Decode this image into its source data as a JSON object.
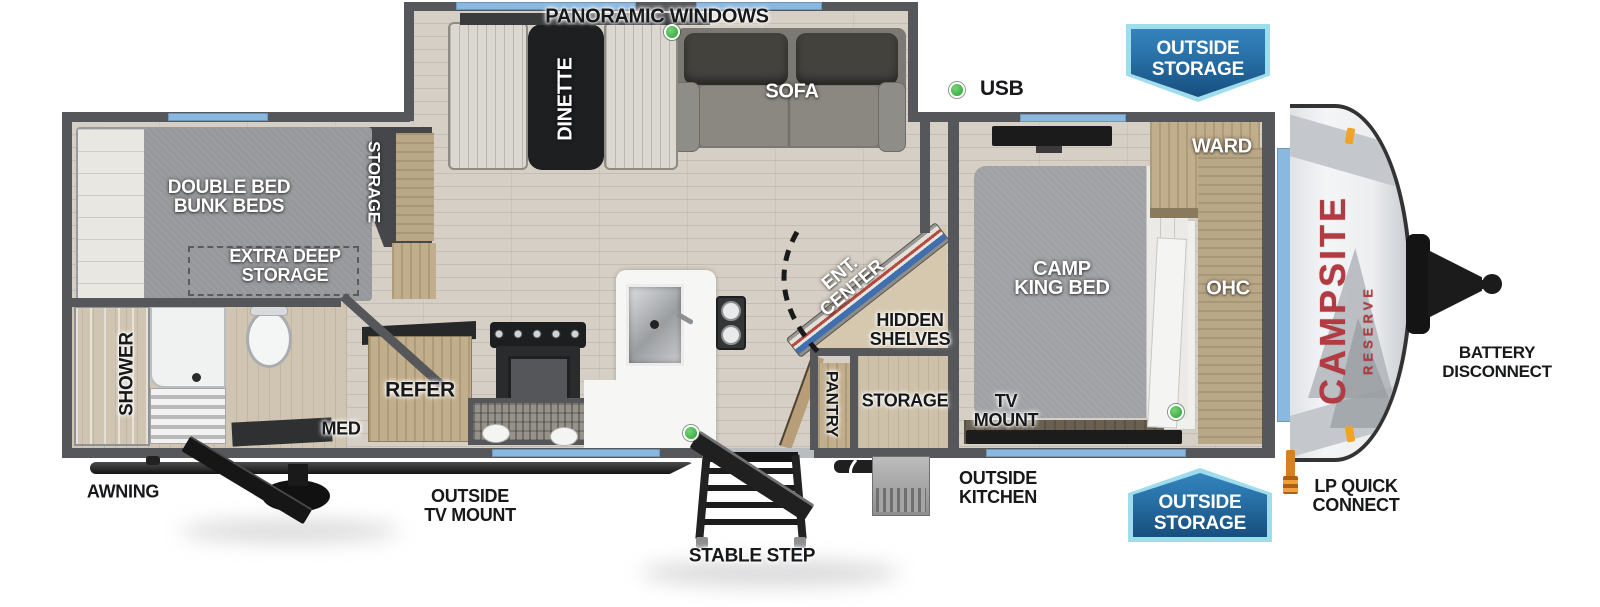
{
  "floorplan": {
    "brand": {
      "name": "CAMPSITE",
      "sub": "RESERVE",
      "color": "#b23a40"
    },
    "colors": {
      "badge_blue": "#1d6096",
      "badge_border": "#9fdcec",
      "window_blue": "#8ab8de",
      "wall_gray": "#55575a",
      "green_marker": "#3cb043",
      "lp_orange": "#d87f1f"
    },
    "exterior": {
      "panoramic_windows": "PANORAMIC WINDOWS",
      "usb": "USB",
      "outside_storage_top": {
        "line1": "OUTSIDE",
        "line2": "STORAGE"
      },
      "outside_storage_bottom": {
        "line1": "OUTSIDE",
        "line2": "STORAGE"
      },
      "battery_disconnect": {
        "line1": "BATTERY",
        "line2": "DISCONNECT"
      },
      "awning": "AWNING",
      "outside_tv_mount": {
        "line1": "OUTSIDE",
        "line2": "TV MOUNT"
      },
      "stable_step": "STABLE STEP",
      "outside_kitchen": {
        "line1": "OUTSIDE",
        "line2": "KITCHEN"
      },
      "lp_quick_connect": {
        "line1": "LP QUICK",
        "line2": "CONNECT"
      }
    },
    "interior": {
      "dinette": "DINETTE",
      "sofa": "SOFA",
      "ward": "WARD",
      "ohc": "OHC",
      "camp_king_bed": {
        "line1": "CAMP",
        "line2": "KING BED"
      },
      "tv_mount": {
        "line1": "TV",
        "line2": "MOUNT"
      },
      "storage_bedroom": "STORAGE",
      "pantry": "PANTRY",
      "hidden_shelves": {
        "line1": "HIDDEN",
        "line2": "SHELVES"
      },
      "ent_center": {
        "line1": "ENT.",
        "line2": "CENTER"
      },
      "double_bed_bunk": {
        "line1": "DOUBLE BED",
        "line2": "BUNK BEDS"
      },
      "storage_bunk": "STORAGE",
      "extra_deep_storage": {
        "line1": "EXTRA DEEP",
        "line2": "STORAGE"
      },
      "shower": "SHOWER",
      "med": "MED",
      "refer": "REFER"
    }
  }
}
